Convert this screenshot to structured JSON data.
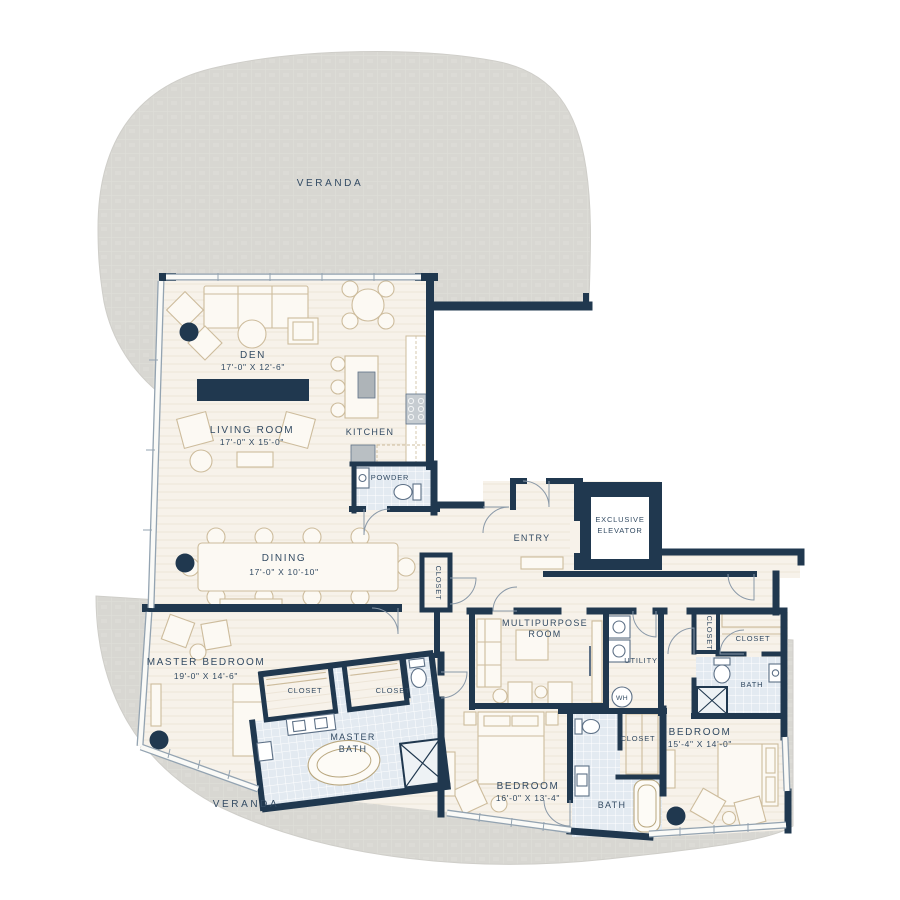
{
  "colors": {
    "wall": "#20384F",
    "floor": "#F7F2EA",
    "tile": "#E3EAF1",
    "veranda": "#D8D7D2",
    "label_text": "#334B63",
    "furniture_outline": "#CDBC9C"
  },
  "areas": {
    "veranda_top": {
      "label": "VERANDA"
    },
    "veranda_bottom": {
      "label": "VERANDA"
    },
    "den": {
      "name": "DEN",
      "dims": "17'-0\" X 12'-6\""
    },
    "living_room": {
      "name": "LIVING ROOM",
      "dims": "17'-0\" X 15'-0\""
    },
    "kitchen": {
      "name": "KITCHEN"
    },
    "powder": {
      "name": "POWDER"
    },
    "entry": {
      "name": "ENTRY"
    },
    "elevator": {
      "line1": "EXCLUSIVE",
      "line2": "ELEVATOR"
    },
    "hall_closet": {
      "name": "CLOSET"
    },
    "dining": {
      "name": "DINING",
      "dims": "17'-0\" X 10'-10\""
    },
    "master_bedroom": {
      "name": "MASTER BEDROOM",
      "dims": "19'-0\" X 14'-6\""
    },
    "master_closet_left": {
      "name": "CLOSET"
    },
    "master_closet_right": {
      "name": "CLOSET"
    },
    "master_bath": {
      "line1": "MASTER",
      "line2": "BATH"
    },
    "multipurpose_room": {
      "line1": "MULTIPURPOSE",
      "line2": "ROOM"
    },
    "utility": {
      "name": "UTILITY"
    },
    "water_heater": {
      "label": "WH"
    },
    "bedroom_center": {
      "name": "BEDROOM",
      "dims": "16'-0\" X 13'-4\""
    },
    "bath_center": {
      "name": "BATH"
    },
    "closet_center": {
      "name": "CLOSET"
    },
    "closet_right_small": {
      "name": "CLOSET"
    },
    "closet_right": {
      "name": "CLOSET"
    },
    "bath_right": {
      "name": "BATH"
    },
    "bedroom_right": {
      "name": "BEDROOM",
      "dims": "15'-4\" X 14'-0\""
    }
  }
}
